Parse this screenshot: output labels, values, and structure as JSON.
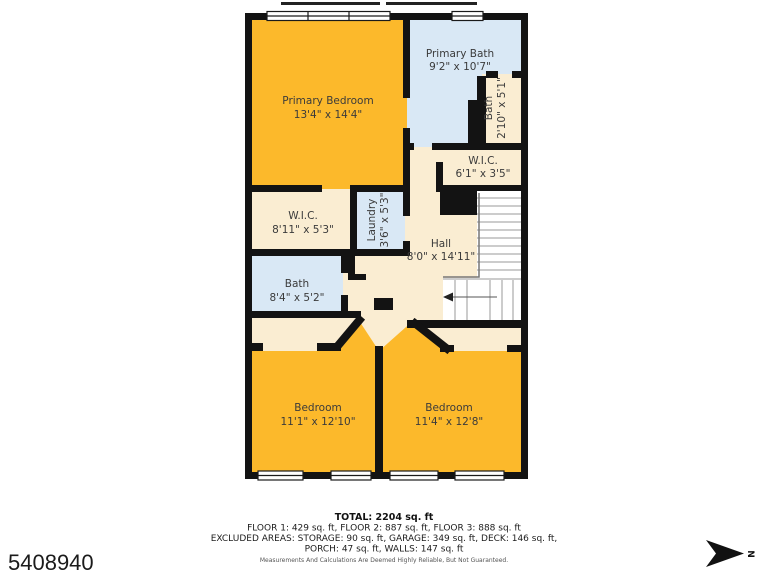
{
  "page": {
    "listing_id": "5408940",
    "north_label": "N"
  },
  "rooms": {
    "primary_bedroom": {
      "name": "Primary Bedroom",
      "dims": "13'4\" x 14'4\""
    },
    "primary_bath": {
      "name": "Primary Bath",
      "dims": "9'2\" x 10'7\""
    },
    "bath_ensuite": {
      "name": "Bath",
      "dims": "2'10\" x 5'1\""
    },
    "wic_right": {
      "name": "W.I.C.",
      "dims": "6'1\" x 3'5\""
    },
    "wic_left": {
      "name": "W.I.C.",
      "dims": "8'11\" x 5'3\""
    },
    "laundry": {
      "name": "Laundry",
      "dims": "3'6\" x 5'3\""
    },
    "hall": {
      "name": "Hall",
      "dims": "8'0\" x 14'11\""
    },
    "bath_left": {
      "name": "Bath",
      "dims": "8'4\" x 5'2\""
    },
    "bedroom_left": {
      "name": "Bedroom",
      "dims": "11'1\" x 12'10\""
    },
    "bedroom_right": {
      "name": "Bedroom",
      "dims": "11'4\" x 12'8\""
    }
  },
  "summary": {
    "total": "TOTAL: 2204 sq. ft",
    "floors": "FLOOR 1: 429 sq. ft, FLOOR 2: 887 sq. ft, FLOOR 3: 888 sq. ft",
    "excluded1": "EXCLUDED AREAS: STORAGE: 90 sq. ft, GARAGE: 349 sq. ft, DECK: 146 sq. ft,",
    "excluded2": "PORCH: 47 sq. ft, WALLS: 147 sq. ft",
    "disclaimer": "Measurements And Calculations Are Deemed Highly Reliable, But Not Guaranteed."
  },
  "colors": {
    "bedroom": "#FCB92B",
    "bath": "#D9E8F5",
    "floor": "#FAEDD2",
    "wall": "#131313"
  }
}
